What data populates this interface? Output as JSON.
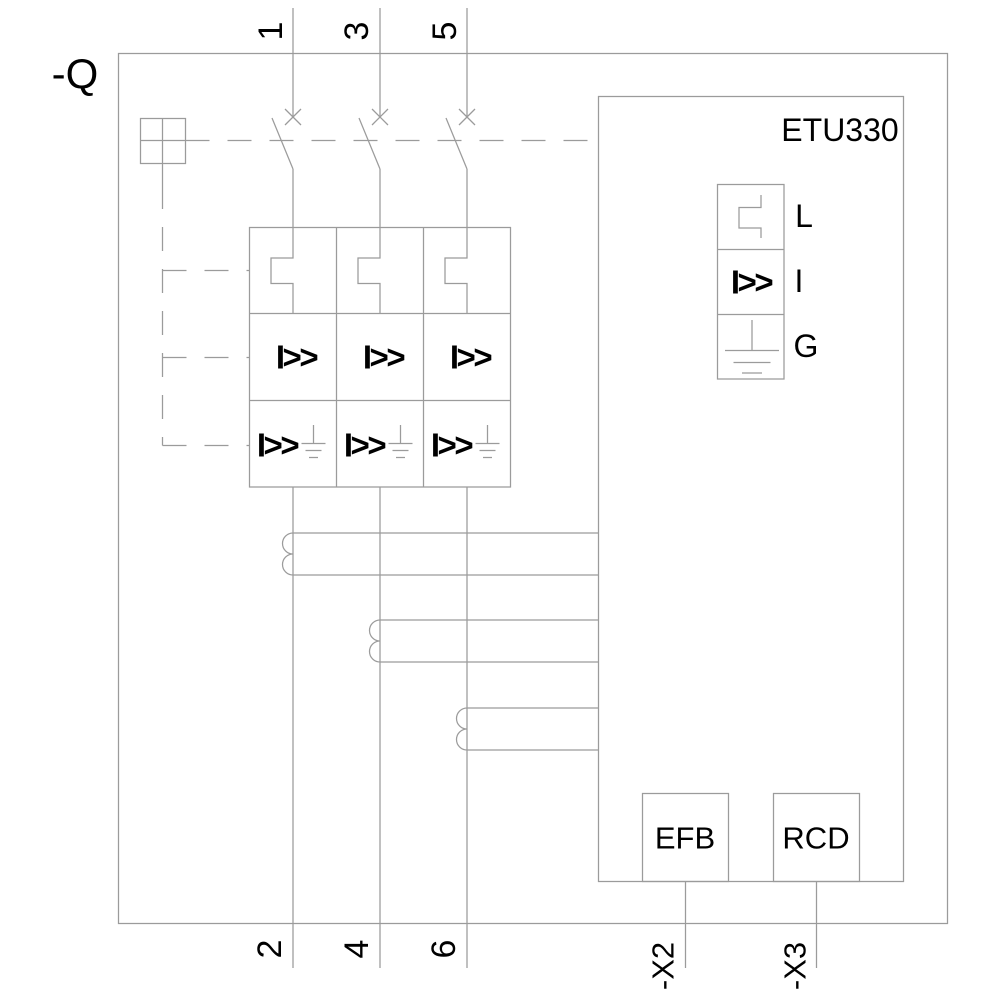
{
  "diagram": {
    "device_tag": "-Q",
    "trip_unit": {
      "name": "ETU330",
      "functions": [
        {
          "label": "L",
          "icon": "long-time-curve-icon"
        },
        {
          "label": "I",
          "symbol": "I>>"
        },
        {
          "label": "G",
          "icon": "ground-icon"
        }
      ]
    },
    "top_terminals": [
      "1",
      "3",
      "5"
    ],
    "bottom_terminals": [
      "2",
      "4",
      "6"
    ],
    "aux_terminals": [
      "-X2",
      "-X3"
    ],
    "pole_matrix": {
      "short_circuit_symbol": "I>>",
      "ground_fault_symbol": "I>>"
    },
    "modules": [
      {
        "label": "EFB"
      },
      {
        "label": "RCD"
      }
    ],
    "colors": {
      "line": "#9b9b9b",
      "text": "#000000"
    }
  }
}
